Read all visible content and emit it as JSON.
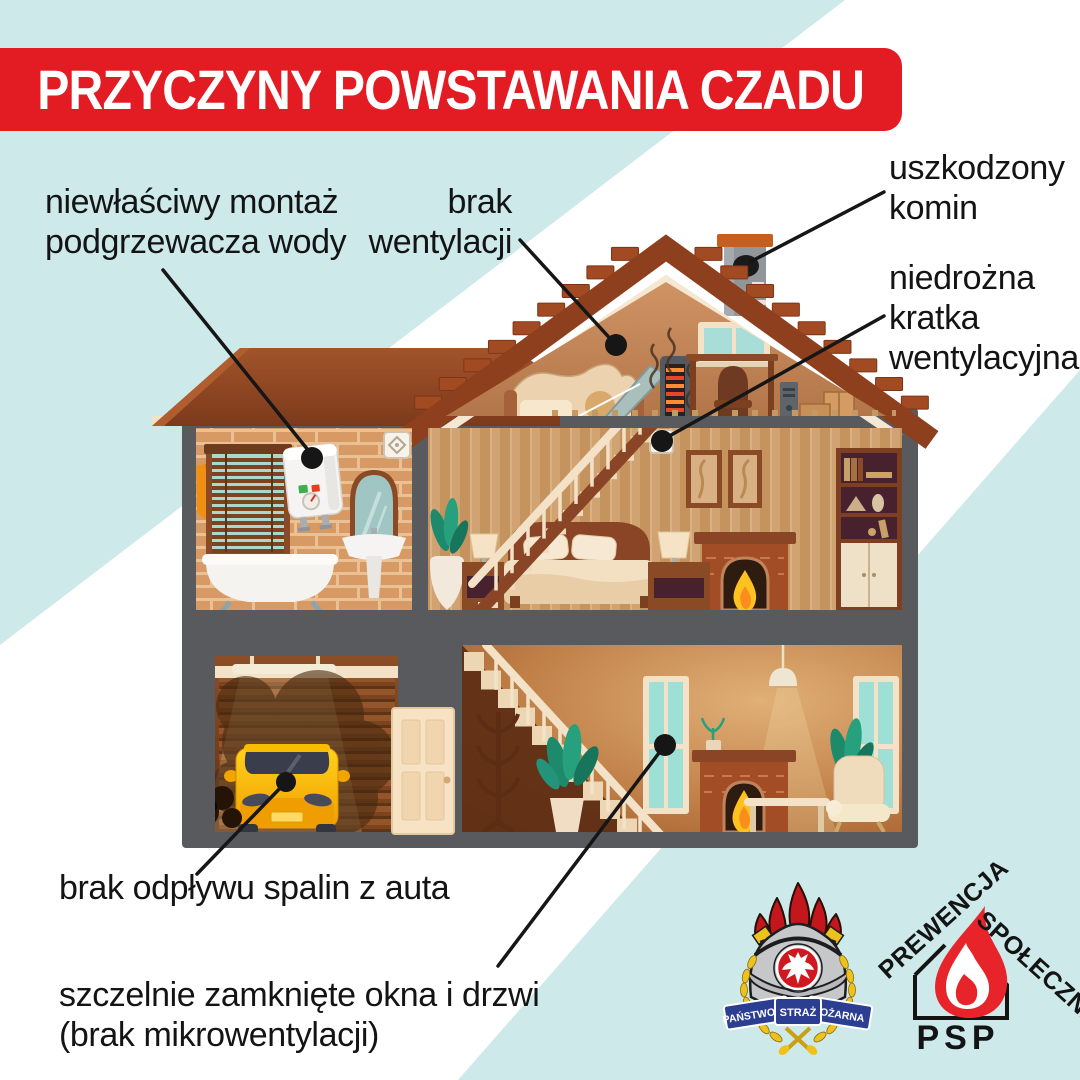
{
  "title": "PRZYCZYNY POWSTAWANIA CZADU",
  "labels": {
    "water_heater": [
      "niewłaściwy montaż",
      "podgrzewacza wody"
    ],
    "no_ventilation": [
      "brak",
      "wentylacji"
    ],
    "damaged_chimney": [
      "uszkodzony",
      "komin"
    ],
    "blocked_grille": [
      "niedrożna",
      "kratka",
      "wentylacyjna"
    ],
    "car_exhaust": [
      "brak odpływu spalin z auta"
    ],
    "sealed_windows": [
      "szczelnie zamknięte okna i drzwi",
      "(brak mikrowentylacji)"
    ]
  },
  "logos": {
    "psp_crest": {
      "ribbon_left": "PAŃSTWOWA",
      "ribbon_center": "STRAŻ",
      "ribbon_right": "POŻARNA"
    },
    "prevention": {
      "word_left": "PREWENCJA",
      "word_right": "SPOŁECZNA",
      "acronym": "PSP"
    }
  },
  "colors": {
    "background_blue": "#cde9e9",
    "band_white": "#ffffff",
    "banner_red": "#e31b22",
    "text_black": "#141414",
    "frame_gray": "#595a5e",
    "roof_brown": "#8e3f1d",
    "logo_red": "#e8242b"
  }
}
